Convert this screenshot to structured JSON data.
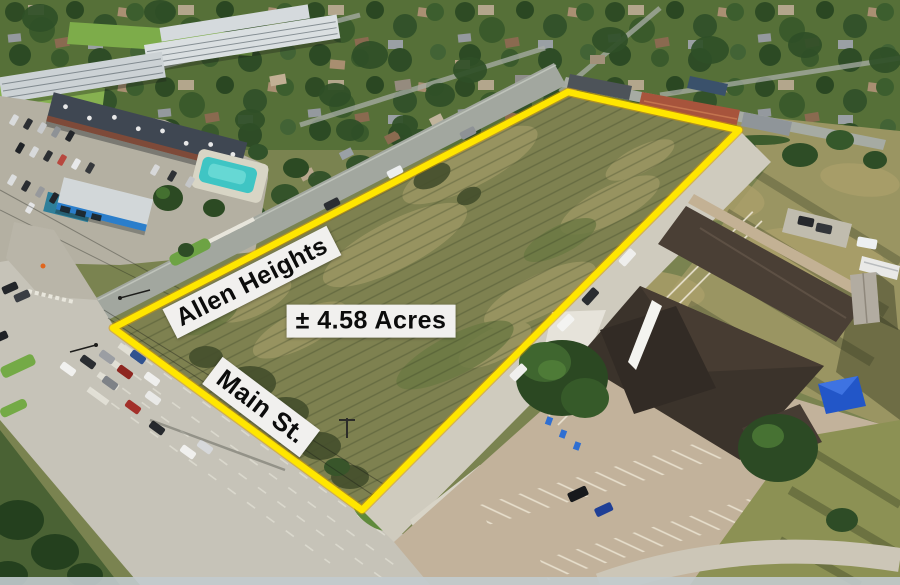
{
  "annotations": {
    "street_label_1": "Allen Heights",
    "street_label_2": "Main St.",
    "area_label": "± 4.58 Acres"
  },
  "colors": {
    "boundary": "#ffe600",
    "boundary_halo": "#d89f00",
    "label_bg": "#f1f0ee",
    "label_text": "#0c0c0c"
  }
}
